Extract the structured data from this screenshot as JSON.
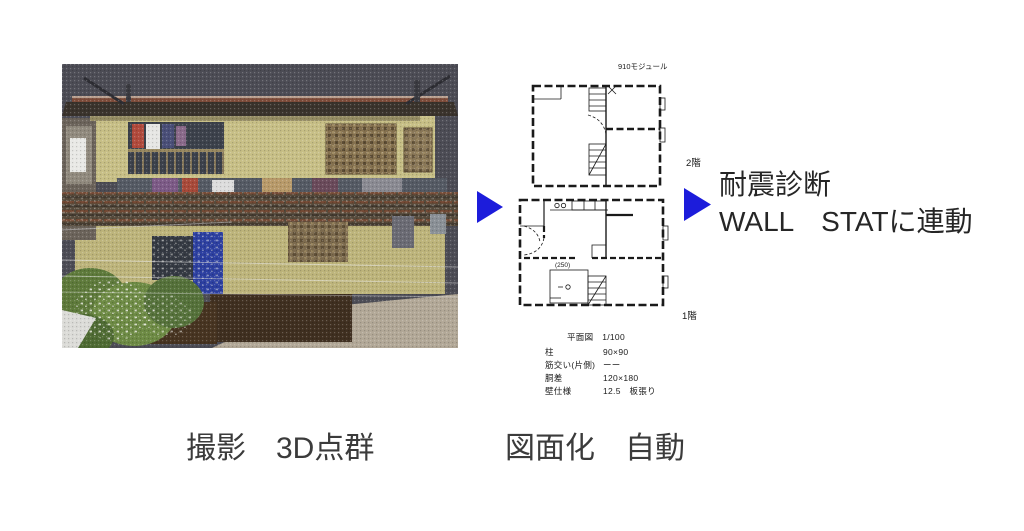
{
  "colors": {
    "arrow_blue": "#1c1cdb",
    "pointcloud_background": "#4c4c55",
    "house_wall": "#c7bf86"
  },
  "pointcloud": {
    "description": "3D point cloud scan of a two-story house"
  },
  "plan": {
    "module_label": "910モジュール",
    "floor2_label": "2階",
    "floor1_label": "1階",
    "dim_label": "(250)",
    "legend_title": "平面図　1/100",
    "legend_rows": [
      {
        "label": "柱",
        "value": "90×90"
      },
      {
        "label": "筋交い(片側)",
        "value": "ーー"
      },
      {
        "label": "胴差",
        "value": "120×180"
      },
      {
        "label": "壁仕様",
        "value": "12.5　板張り"
      }
    ]
  },
  "captions": {
    "left": "撮影　3D点群",
    "middle": "図面化　自動"
  },
  "result": {
    "line1": "耐震診断",
    "line2": "WALL　STATに連動"
  }
}
